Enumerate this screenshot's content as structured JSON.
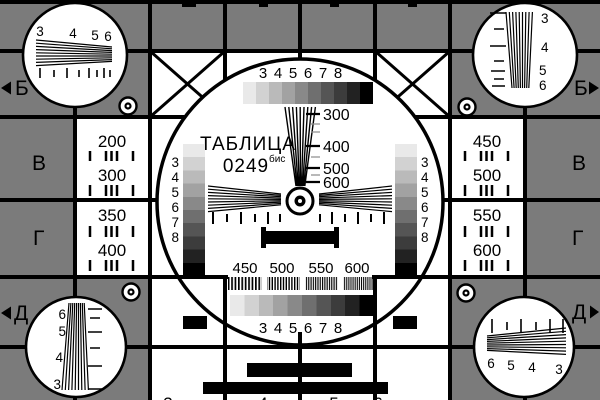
{
  "card": {
    "title": "ТАБЛИЦА",
    "number": "0249",
    "number_suffix": "бис"
  },
  "colors": {
    "background_gray": "#7b7b7b",
    "foreground": "#000000",
    "surface": "#ffffff"
  },
  "edge_letters": {
    "left": [
      "Б",
      "В",
      "Г",
      "Д"
    ],
    "right": [
      "Б",
      "В",
      "Г",
      "Д"
    ]
  },
  "left_panel": {
    "values": [
      "200",
      "300",
      "350",
      "400"
    ]
  },
  "right_panel": {
    "values": [
      "450",
      "500",
      "550",
      "600"
    ]
  },
  "center_circle": {
    "top_scale": [
      "3",
      "4",
      "5",
      "6",
      "7",
      "8"
    ],
    "bottom_scale": [
      "3",
      "4",
      "5",
      "6",
      "7",
      "8"
    ],
    "left_stair": [
      "3",
      "4",
      "5",
      "6",
      "7",
      "8"
    ],
    "right_stair": [
      "3",
      "4",
      "5",
      "6",
      "7",
      "8"
    ],
    "freq_labels": [
      "300",
      "400",
      "500",
      "600"
    ],
    "burst_labels": [
      "450",
      "500",
      "550",
      "600"
    ]
  },
  "corner_wedges": {
    "top_left": [
      "3",
      "4",
      "5",
      "6"
    ],
    "top_right": [
      "3",
      "4",
      "5",
      "6"
    ],
    "bottom_left": [
      "6",
      "5",
      "4",
      "3"
    ],
    "bottom_right": [
      "6",
      "5",
      "4",
      "3"
    ]
  },
  "clipped_bottom_digits": [
    "3",
    "4",
    "5",
    "6"
  ]
}
